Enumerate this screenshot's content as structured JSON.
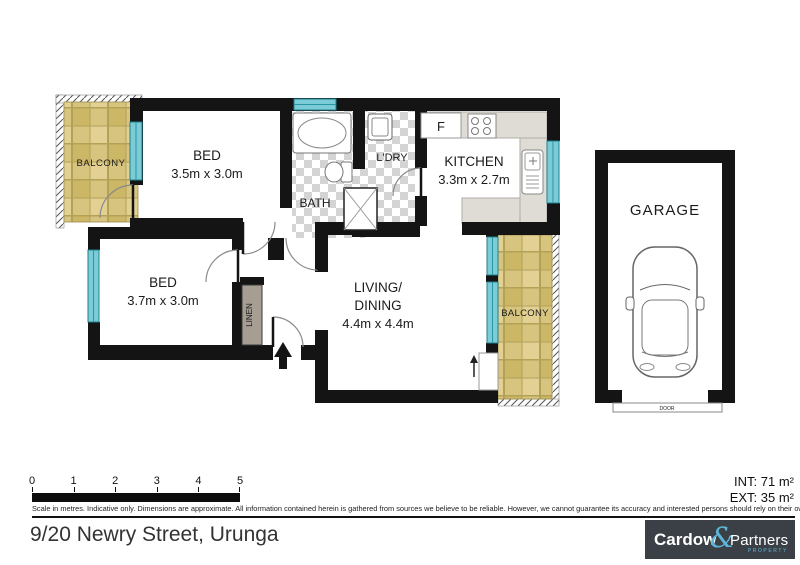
{
  "page": {
    "address": "9/20 Newry Street, Urunga"
  },
  "areas": {
    "internal": "INT: 71 m²",
    "external": "EXT: 35 m²"
  },
  "disclaimer": "Scale in metres. Indicative only. Dimensions are approximate. All information contained herein is gathered from sources we believe to be reliable. However, we cannot guarantee its accuracy and interested persons should rely on their own enquiries.",
  "scale_bar": {
    "labels": [
      "0",
      "1",
      "2",
      "3",
      "4",
      "5"
    ]
  },
  "rooms": {
    "balcony_left": {
      "label": "BALCONY"
    },
    "bed_1": {
      "label": "BED",
      "dims": "3.5m x 3.0m"
    },
    "bath": {
      "label": "BATH"
    },
    "laundry": {
      "label": "L'DRY"
    },
    "kitchen": {
      "label": "KITCHEN",
      "dims": "3.3m x 2.7m",
      "fridge": "F"
    },
    "bed_2": {
      "label": "BED",
      "dims": "3.7m x 3.0m"
    },
    "linen": {
      "label": "LINEN"
    },
    "living_dining": {
      "label_line1": "LIVING/",
      "label_line2": "DINING",
      "dims": "4.4m x 4.4m"
    },
    "balcony_right": {
      "label": "BALCONY"
    },
    "garage": {
      "label": "GARAGE",
      "door_label": "DOOR"
    }
  },
  "logo": {
    "name_part1": "Cardow",
    "ampersand": "&",
    "name_part2": "Partners",
    "tagline": "PROPERTY"
  },
  "colors": {
    "wall": "#141414",
    "window": "#7bccd6",
    "balcony_tile": "#d7c47f",
    "wet_area_tile": "#d4d4d4",
    "counter": "#dfdcd6",
    "linen_fill": "#a69d93",
    "logo_bg": "#3b4046",
    "logo_accent": "#5db5d8"
  }
}
